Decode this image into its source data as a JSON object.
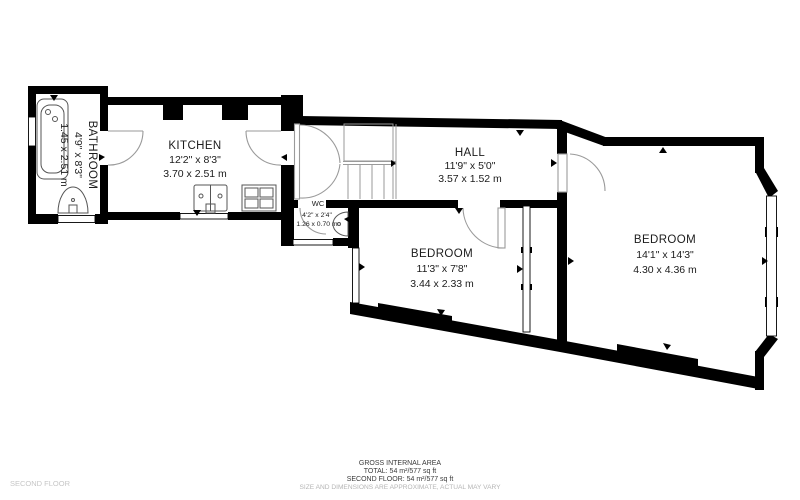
{
  "plan": {
    "floor_label": "SECOND FLOOR",
    "rooms": [
      {
        "id": "bathroom",
        "name": "BATHROOM",
        "imperial": "4'9\" x 8'3\"",
        "metric": "1.45 x 2.51 m"
      },
      {
        "id": "kitchen",
        "name": "KITCHEN",
        "imperial": "12'2\" x 8'3\"",
        "metric": "3.70 x 2.51 m"
      },
      {
        "id": "hall",
        "name": "HALL",
        "imperial": "11'9\" x 5'0\"",
        "metric": "3.57 x 1.52 m"
      },
      {
        "id": "wc",
        "name": "WC",
        "imperial": "4'2\" x 2'4\"",
        "metric": "1.26 x 0.70 m"
      },
      {
        "id": "bedroom_small",
        "name": "BEDROOM",
        "imperial": "11'3\" x 7'8\"",
        "metric": "3.44 x 2.33 m"
      },
      {
        "id": "bedroom_large",
        "name": "BEDROOM",
        "imperial": "14'1\" x 14'3\"",
        "metric": "4.30 x 4.36 m"
      }
    ],
    "footer": {
      "title": "GROSS INTERNAL AREA",
      "total": "TOTAL: 54 m²/577 sq ft",
      "floor_total": "SECOND FLOOR: 54 m²/577 sq ft",
      "disclaimer": "SIZE AND DIMENSIONS ARE APPROXIMATE, ACTUAL MAY VARY"
    },
    "colors": {
      "wall": "#000000",
      "label": "#1c1c1c",
      "muted": "#b5b5b5",
      "floor_label": "#c6c6c6"
    }
  }
}
